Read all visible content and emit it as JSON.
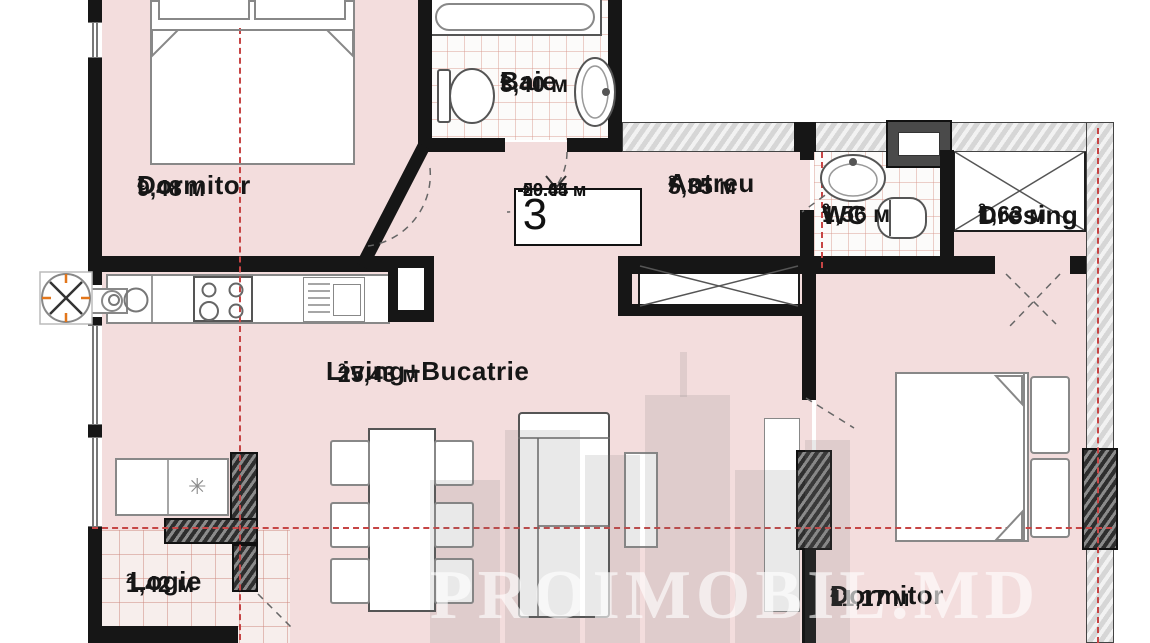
{
  "title": "Apartment floor plan",
  "watermark": "PROIMOBIL.MD",
  "sup": "2",
  "info_box": {
    "number": "3",
    "total_area": "59.44 м",
    "living_area": "20.65 м"
  },
  "rooms": {
    "dormitor1": {
      "label": "Dormitor",
      "area": "9,48 м"
    },
    "baie": {
      "label": "Baie",
      "area": "3,40 м"
    },
    "antreu": {
      "label": "Antreu",
      "area": "5,35 м"
    },
    "wc": {
      "label": "WC",
      "area": "1,56 м"
    },
    "dresing": {
      "label": "Dresing",
      "area": "1,63 м"
    },
    "living": {
      "label": "Living+Bucatrie",
      "area": "25,43 м"
    },
    "logie": {
      "label": "Logie",
      "area": "1,42 м"
    },
    "dormitor2": {
      "label": "Dormitor",
      "area": "11,17 м"
    }
  },
  "icons": {
    "snowflake": "✳",
    "fan": "ventilation-fan"
  },
  "colors": {
    "floor": "#f3dddd",
    "wall": "#161616",
    "axis_red": "#c64545",
    "tile_line": "#d89690",
    "watermark": "rgba(255,255,255,0.62)",
    "accent_orange": "#e2761b"
  }
}
